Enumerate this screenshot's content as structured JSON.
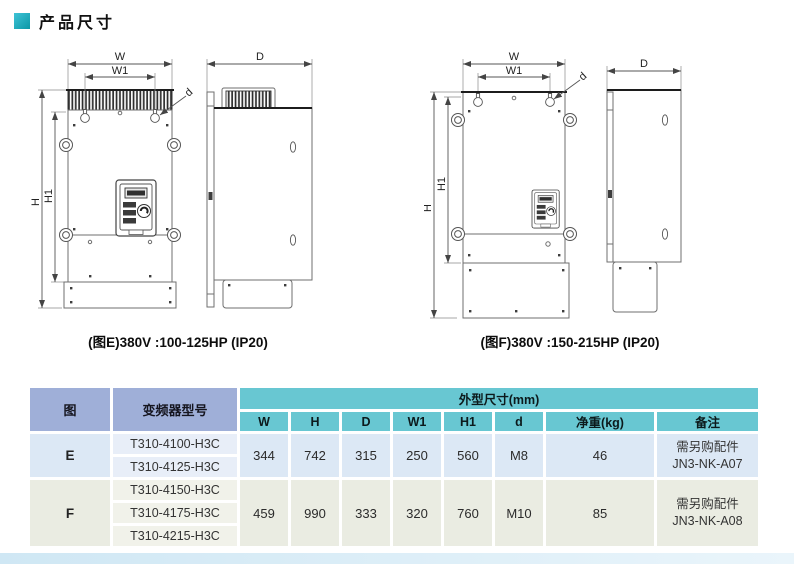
{
  "page": {
    "title": "产品尺寸"
  },
  "figures": {
    "e": {
      "caption": "(图E)380V :100-125HP (IP20)",
      "labels": {
        "w": "W",
        "w1": "W1",
        "h": "H",
        "h1": "H1",
        "hole": "d",
        "depth": "D"
      }
    },
    "f": {
      "caption": "(图F)380V :150-215HP (IP20)",
      "labels": {
        "w": "W",
        "w1": "W1",
        "h": "H",
        "h1": "H1",
        "hole": "d",
        "depth": "D"
      }
    }
  },
  "table": {
    "header": {
      "figure": "图",
      "model": "变频器型号",
      "dims_group": "外型尺寸(mm)",
      "columns": [
        "W",
        "H",
        "D",
        "W1",
        "H1",
        "d",
        "净重(kg)",
        "备注"
      ]
    },
    "groups": [
      {
        "figure": "E",
        "models": [
          "T310-4100-H3C",
          "T310-4125-H3C"
        ],
        "values": [
          "344",
          "742",
          "315",
          "250",
          "560",
          "M8",
          "46"
        ],
        "remark": "需另购配件\nJN3-NK-A07"
      },
      {
        "figure": "F",
        "models": [
          "T310-4150-H3C",
          "T310-4175-H3C",
          "T310-4215-H3C"
        ],
        "values": [
          "459",
          "990",
          "333",
          "320",
          "760",
          "M10",
          "85"
        ],
        "remark": "需另购配件\nJN3-NK-A08"
      }
    ]
  },
  "colors": {
    "accent_teal": "#68c7d2",
    "header_blue": "#9fafd8",
    "row_e_bg": "#dce8f5",
    "row_e_model_bg": "#e8eef8",
    "row_f_bg": "#eaece2",
    "row_f_model_bg": "#f1f2ea",
    "title_icon_start": "#3fc3d6",
    "title_icon_end": "#0b97a6"
  }
}
